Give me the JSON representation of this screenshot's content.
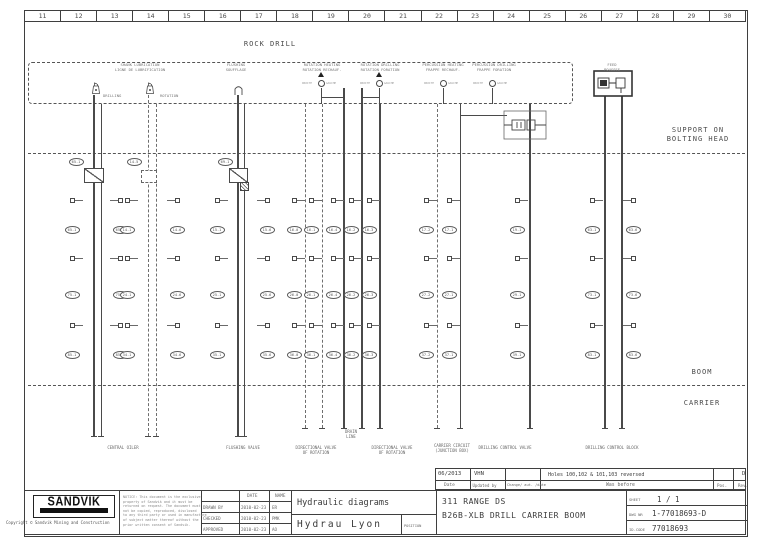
{
  "ruler": {
    "cells": [
      "11",
      "12",
      "13",
      "14",
      "15",
      "16",
      "17",
      "18",
      "19",
      "20",
      "21",
      "22",
      "23",
      "24",
      "25",
      "26",
      "27",
      "28",
      "29",
      "30"
    ]
  },
  "regions": {
    "rock_drill": "ROCK DRILL",
    "support": "SUPPORT ON\nBOLTING HEAD",
    "boom": "BOOM",
    "carrier": "CARRIER"
  },
  "revision": {
    "entry": {
      "date": "06/2013",
      "updated_by": "VHN",
      "change": "",
      "was_before": "Holes 100,102 & 101,103 reversed",
      "pos": "",
      "rev": "D"
    },
    "headers": {
      "date": "Date",
      "updated_by": "Updated by",
      "change": "Change/ aut. /date",
      "was_before": "Was before",
      "pos": "Pos.",
      "rev": "Rev."
    }
  },
  "title_block": {
    "logo": "SANDVIK",
    "copyright": "Copyright © Sandvik Mining and Construction",
    "notice": "NOTICE: This document is the exclusive\nproperty of Sandvik and it must be\nreturned on request. The document must\nnot be copied, reproduced, disclosed\nto any third party or used in manufacture\nof subject matter thereof without the\nprior written consent of Sandvik.",
    "approvals": {
      "date_header": "DATE",
      "name_header": "NAME",
      "rows": [
        {
          "role": "DRAWN BY",
          "date": "2010-02-23",
          "name": "ER"
        },
        {
          "role": "CHECKED",
          "date": "2010-02-23",
          "name": "PMK"
        },
        {
          "role": "APPROVED",
          "date": "2010-02-23",
          "name": "AO"
        }
      ]
    },
    "department": "Hydraulic diagrams",
    "office": "Hydrau Lyon",
    "position_label": "POSITION",
    "project_range": "311 RANGE DS",
    "project_title": "B26B-XLB DRILL CARRIER BOOM",
    "sheet_label": "SHEET",
    "sheet_value": "1 /  1",
    "dwg_label": "DWG NR",
    "dwg_value": "1-77018693-D",
    "idcode_label": "ID-CODE",
    "idcode_value": "77018693"
  },
  "schematic": {
    "dashed_box": {
      "x": 28,
      "y": 62,
      "w": 545,
      "h": 42
    },
    "separators": [
      {
        "y": 153,
        "x1": 28,
        "x2": 745
      },
      {
        "y": 385,
        "x1": 28,
        "x2": 745
      }
    ],
    "pipes": [
      {
        "x": 94,
        "y1": 95,
        "y2": 436,
        "style": "solid",
        "w": 1.5
      },
      {
        "x": 101,
        "y1": 104,
        "y2": 436,
        "style": "solid",
        "w": 1
      },
      {
        "x": 148,
        "y1": 95,
        "y2": 436,
        "style": "dashed",
        "w": 1
      },
      {
        "x": 156,
        "y1": 104,
        "y2": 436,
        "style": "dashed",
        "w": 1
      },
      {
        "x": 238,
        "y1": 95,
        "y2": 436,
        "style": "solid",
        "w": 1.5
      },
      {
        "x": 244,
        "y1": 104,
        "y2": 436,
        "style": "solid",
        "w": 1
      },
      {
        "x": 305,
        "y1": 104,
        "y2": 428,
        "style": "dashed",
        "w": 1
      },
      {
        "x": 322,
        "y1": 104,
        "y2": 428,
        "style": "dashed",
        "w": 1
      },
      {
        "x": 344,
        "y1": 88,
        "y2": 428,
        "style": "solid",
        "w": 1.8
      },
      {
        "x": 362,
        "y1": 88,
        "y2": 428,
        "style": "solid",
        "w": 1.8
      },
      {
        "x": 380,
        "y1": 104,
        "y2": 428,
        "style": "solid",
        "w": 1.8
      },
      {
        "x": 437,
        "y1": 104,
        "y2": 428,
        "style": "dashed",
        "w": 1
      },
      {
        "x": 460,
        "y1": 104,
        "y2": 428,
        "style": "solid",
        "w": 1
      },
      {
        "x": 530,
        "y1": 104,
        "y2": 428,
        "style": "solid",
        "w": 2
      },
      {
        "x": 605,
        "y1": 96,
        "y2": 428,
        "style": "solid",
        "w": 1.2
      },
      {
        "x": 622,
        "y1": 96,
        "y2": 428,
        "style": "solid",
        "w": 1.2
      },
      {
        "x": 321,
        "y1": 88,
        "y2": 104,
        "style": "solid",
        "w": 1
      },
      {
        "x": 379,
        "y1": 88,
        "y2": 104,
        "style": "solid",
        "w": 1
      },
      {
        "x": 443,
        "y1": 88,
        "y2": 104,
        "style": "solid",
        "w": 1
      },
      {
        "x": 492,
        "y1": 88,
        "y2": 104,
        "style": "solid",
        "w": 1
      }
    ],
    "hlines": [
      {
        "y": 115,
        "x1": 460,
        "x2": 507
      },
      {
        "y": 97,
        "x1": 321,
        "x2": 344
      },
      {
        "y": 97,
        "x1": 362,
        "x2": 379
      }
    ],
    "square_rows": [
      200,
      258,
      325
    ],
    "oval_rows": [
      230,
      295,
      355
    ],
    "cols": [
      {
        "x": 72,
        "side": "r",
        "labels": [
          "65.1",
          "75.1",
          "85.1"
        ]
      },
      {
        "x": 120,
        "side": "l",
        "labels": [
          "65.6",
          "75.6",
          "85.6"
        ]
      },
      {
        "x": 127,
        "side": "r",
        "labels": [
          "14.1",
          "24.1",
          "34.1"
        ]
      },
      {
        "x": 177,
        "side": "l",
        "labels": [
          "14.6",
          "24.6",
          "34.6"
        ]
      },
      {
        "x": 217,
        "side": "r",
        "labels": [
          "15.1",
          "25.1",
          "35.1"
        ]
      },
      {
        "x": 267,
        "side": "l",
        "labels": [
          "15.6",
          "25.6",
          "35.6"
        ]
      },
      {
        "x": 294,
        "side": "r",
        "labels": [
          "16.0",
          "26.0",
          "36.0"
        ]
      },
      {
        "x": 311,
        "side": "r",
        "labels": [
          "16.1",
          "26.1",
          "36.1"
        ]
      },
      {
        "x": 333,
        "side": "r",
        "labels": [
          "16.4",
          "26.4",
          "36.4"
        ]
      },
      {
        "x": 351,
        "side": "r",
        "labels": [
          "16.2",
          "26.2",
          "36.2"
        ]
      },
      {
        "x": 369,
        "side": "r",
        "labels": [
          "16.3",
          "26.3",
          "36.3"
        ]
      },
      {
        "x": 426,
        "side": "r",
        "labels": [
          "17.2",
          "27.2",
          "37.2"
        ]
      },
      {
        "x": 449,
        "side": "r",
        "labels": [
          "17.1",
          "27.1",
          "37.1"
        ]
      },
      {
        "x": 517,
        "side": "r",
        "labels": [
          "19.1",
          "29.1",
          "39.1"
        ]
      },
      {
        "x": 592,
        "side": "r",
        "labels": [
          "63.1",
          "73.1",
          "83.1"
        ]
      },
      {
        "x": 633,
        "side": "l",
        "labels": [
          "63.6",
          "73.6",
          "83.6"
        ]
      }
    ],
    "top_ovals": [
      {
        "x": 76,
        "y": 162,
        "t": "65.1"
      },
      {
        "x": 134,
        "y": 162,
        "t": "14.5"
      },
      {
        "x": 225,
        "y": 162,
        "t": "69.1"
      }
    ],
    "valve_rects": [
      {
        "x": 84,
        "y": 168,
        "w": 20,
        "h": 15,
        "style": "x"
      },
      {
        "x": 141,
        "y": 170,
        "w": 16,
        "h": 13,
        "style": "dash"
      },
      {
        "x": 229,
        "y": 168,
        "w": 19,
        "h": 15,
        "style": "x"
      },
      {
        "x": 240,
        "y": 182,
        "w": 9,
        "h": 9,
        "style": "hatch"
      }
    ],
    "components": [
      {
        "type": "oiler",
        "x": 90,
        "y": 80
      },
      {
        "type": "oiler",
        "x": 144,
        "y": 80
      },
      {
        "type": "flush",
        "x": 233,
        "y": 81
      },
      {
        "type": "cvalve",
        "x": 321,
        "y": 83,
        "l": "DROITE",
        "r": "GAUCHE"
      },
      {
        "type": "cvalve",
        "x": 379,
        "y": 83,
        "l": "DROITE",
        "r": "GAUCHE"
      },
      {
        "type": "cvalve",
        "x": 443,
        "y": 83,
        "l": "DROITE",
        "r": "GAUCHE"
      },
      {
        "type": "cvalve",
        "x": 492,
        "y": 83,
        "l": "DROITE",
        "r": "GAUCHE"
      },
      {
        "type": "arrow",
        "x": 321,
        "y": 72
      },
      {
        "type": "arrow",
        "x": 379,
        "y": 72
      },
      {
        "type": "feed",
        "x": 593,
        "y": 70
      },
      {
        "type": "check",
        "x": 503,
        "y": 110
      }
    ],
    "component_labels": [
      {
        "x": 140,
        "y": 63,
        "text": "SHANK LUBRICATION\nLIGNE DE LUBRIFICATION"
      },
      {
        "x": 103,
        "y": 94,
        "text": "DRILLING",
        "align": "left"
      },
      {
        "x": 160,
        "y": 94,
        "text": "ROTATION",
        "align": "left"
      },
      {
        "x": 236,
        "y": 63,
        "text": "FLUSHING\nSOUFFLAGE"
      },
      {
        "x": 322,
        "y": 63,
        "text": "ROTATION HEATING\nROTATION RECHAUF."
      },
      {
        "x": 380,
        "y": 63,
        "text": "ROTATION DRILLING\nROTATION FORATION"
      },
      {
        "x": 443,
        "y": 63,
        "text": "PERCUSSION HEATING\nFRAPPE RECHAUF."
      },
      {
        "x": 494,
        "y": 63,
        "text": "PERCUSSION DRILLING\nFRAPPE FORATION"
      },
      {
        "x": 612,
        "y": 63,
        "text": "FEED\nPOUSSEE"
      }
    ],
    "captions": [
      {
        "x": 123,
        "y": 445,
        "text": "CENTRAL OILER"
      },
      {
        "x": 243,
        "y": 445,
        "text": "FLUSHING VALVE"
      },
      {
        "x": 316,
        "y": 445,
        "text": "DIRECTIONAL VALVE\nOF ROTATION"
      },
      {
        "x": 392,
        "y": 445,
        "text": "DIRECTIONAL VALVE\nOF ROTATION"
      },
      {
        "x": 452,
        "y": 443,
        "text": "CARRIER CIRCUIT\n(JUNCTION BOX)"
      },
      {
        "x": 505,
        "y": 445,
        "text": "DRILLING CONTROL VALVE"
      },
      {
        "x": 612,
        "y": 445,
        "text": "DRILLING CONTROL BLOCK"
      },
      {
        "x": 351,
        "y": 429,
        "text": "DRAIN\nLINE"
      }
    ]
  }
}
